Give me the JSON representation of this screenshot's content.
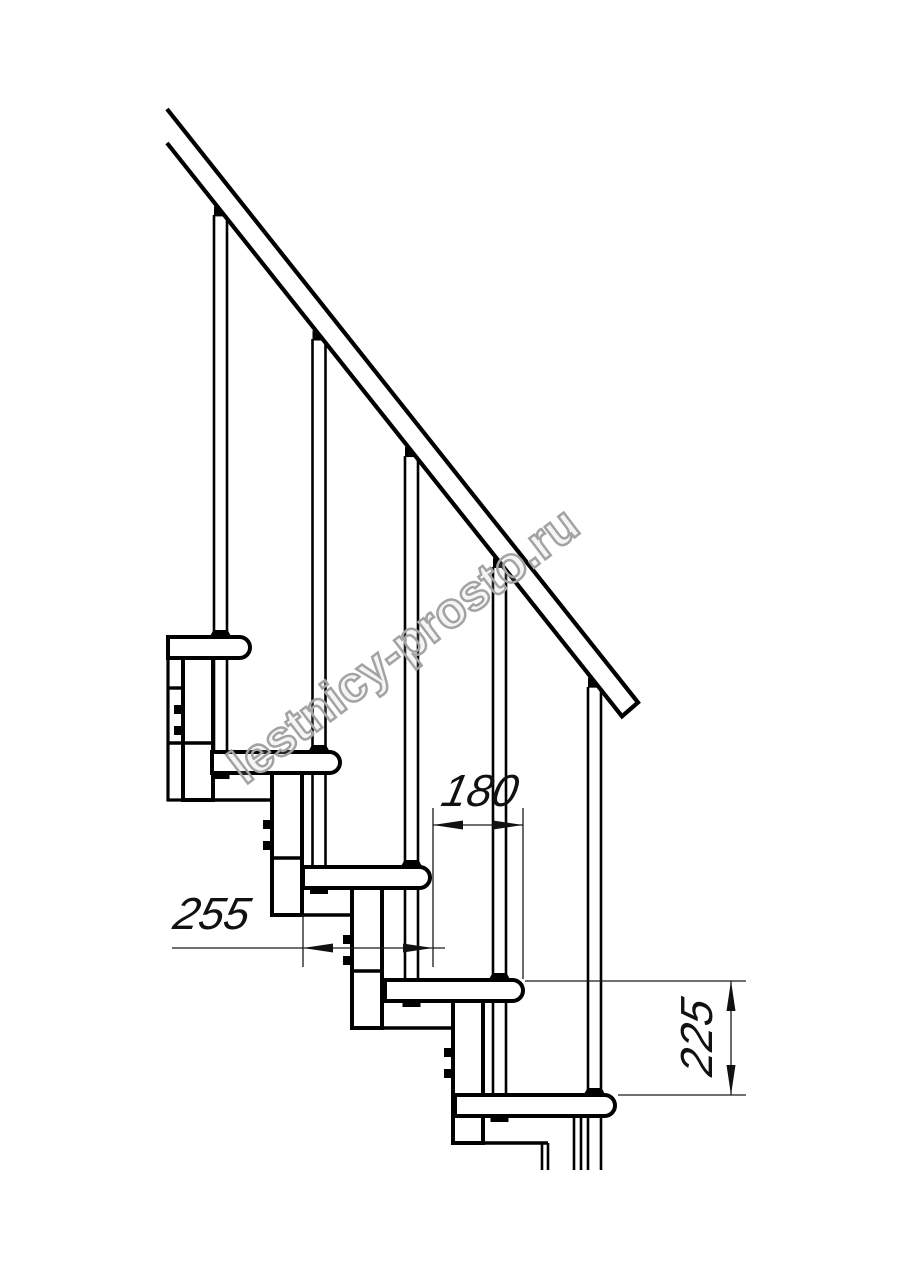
{
  "page": {
    "background": "#ffffff",
    "line_color": "#000000",
    "thin_line_color": "#1a1a1a"
  },
  "watermark": {
    "text": "lestnicy-prosto.ru",
    "color": "#a3a3a3"
  },
  "drawing": {
    "subject": "modular staircase side elevation",
    "treads_visible": 5,
    "balusters_visible": 5
  },
  "dimensions": {
    "step_run": {
      "label": "180",
      "orientation": "horizontal"
    },
    "tread_depth": {
      "label": "255",
      "orientation": "horizontal"
    },
    "riser_height": {
      "label": "225",
      "orientation": "vertical"
    }
  }
}
